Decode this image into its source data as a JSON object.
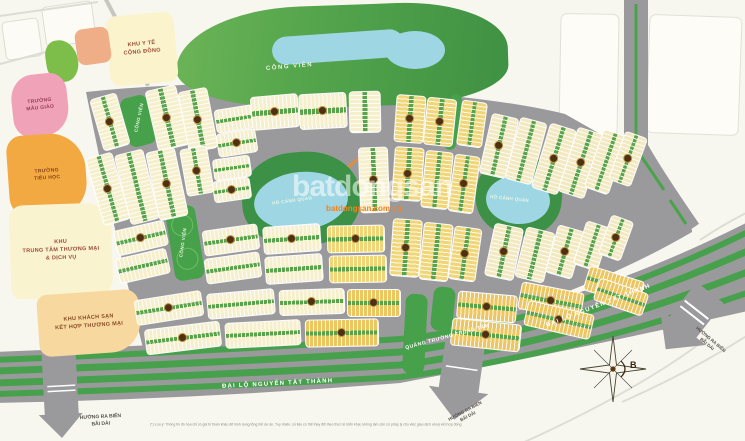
{
  "watermark": {
    "brand": "batdongsan",
    "site": "batdongsan.com.vn",
    "accent": "#f58220"
  },
  "zones": {
    "healthcare": {
      "line1": "KHU Y TẾ",
      "line2": "CỘNG ĐỒNG"
    },
    "kindergarten": {
      "line1": "TRƯỜNG",
      "line2": "MẪU GIÁO"
    },
    "primary_school": {
      "line1": "TRƯỜNG",
      "line2": "TIỂU HỌC"
    },
    "commercial_center": {
      "line1": "KHU",
      "line2": "TRUNG TÂM THƯƠNG MẠI",
      "line3": "& DỊCH VỤ"
    },
    "hotel_commercial": {
      "line1": "KHU KHÁCH SẠN",
      "line2": "KẾT HỢP THƯƠNG MẠI"
    }
  },
  "parks": {
    "main": "CÔNG VIÊN",
    "strip1": "CÔNG VIÊN",
    "strip2": "CÔNG VIÊN"
  },
  "lakes": {
    "left": "HỒ CẢNH QUAN",
    "right": "HỒ CẢNH QUAN"
  },
  "roads": {
    "boulevard": "ĐẠI LỘ NGUYỄN TẤT THÀNH",
    "central_square": "QUẢNG TRƯỜNG TRUNG TÂM"
  },
  "directions": {
    "line1": "HƯỚNG RA BIỂN",
    "line2": "BÃI DÀI"
  },
  "compass": {
    "north": "B"
  },
  "footnote": {
    "text": "(*) Lưu ý: Thông tin đồ họa chỉ có giá trị tham khảo để hình dung tổng thể dự án. Tuy nhiên, số liệu có thể thay đổi theo thực tế triển khai, không làm căn cứ pháp lý cho việc giao dịch và ký kết hợp đồng."
  },
  "colors": {
    "road": "#9a9a9c",
    "boulevard_green": "#47a04b",
    "park_green": "#3f9345",
    "lake_blue": "#9ed7e3",
    "block_cream": "#f6efcb",
    "block_yellow": "#f0d678",
    "block_gold": "#ecc660",
    "block_pale": "#f3e9c0",
    "badge_brown": "#4e3114",
    "badge_ring": "#bd9447",
    "zone_pink": "#f0a3b8",
    "zone_orange": "#f3a942",
    "zone_paleyellow": "#faf3d0",
    "zone_peach": "#f7d9a0",
    "watermark_orange": "#f58220"
  }
}
